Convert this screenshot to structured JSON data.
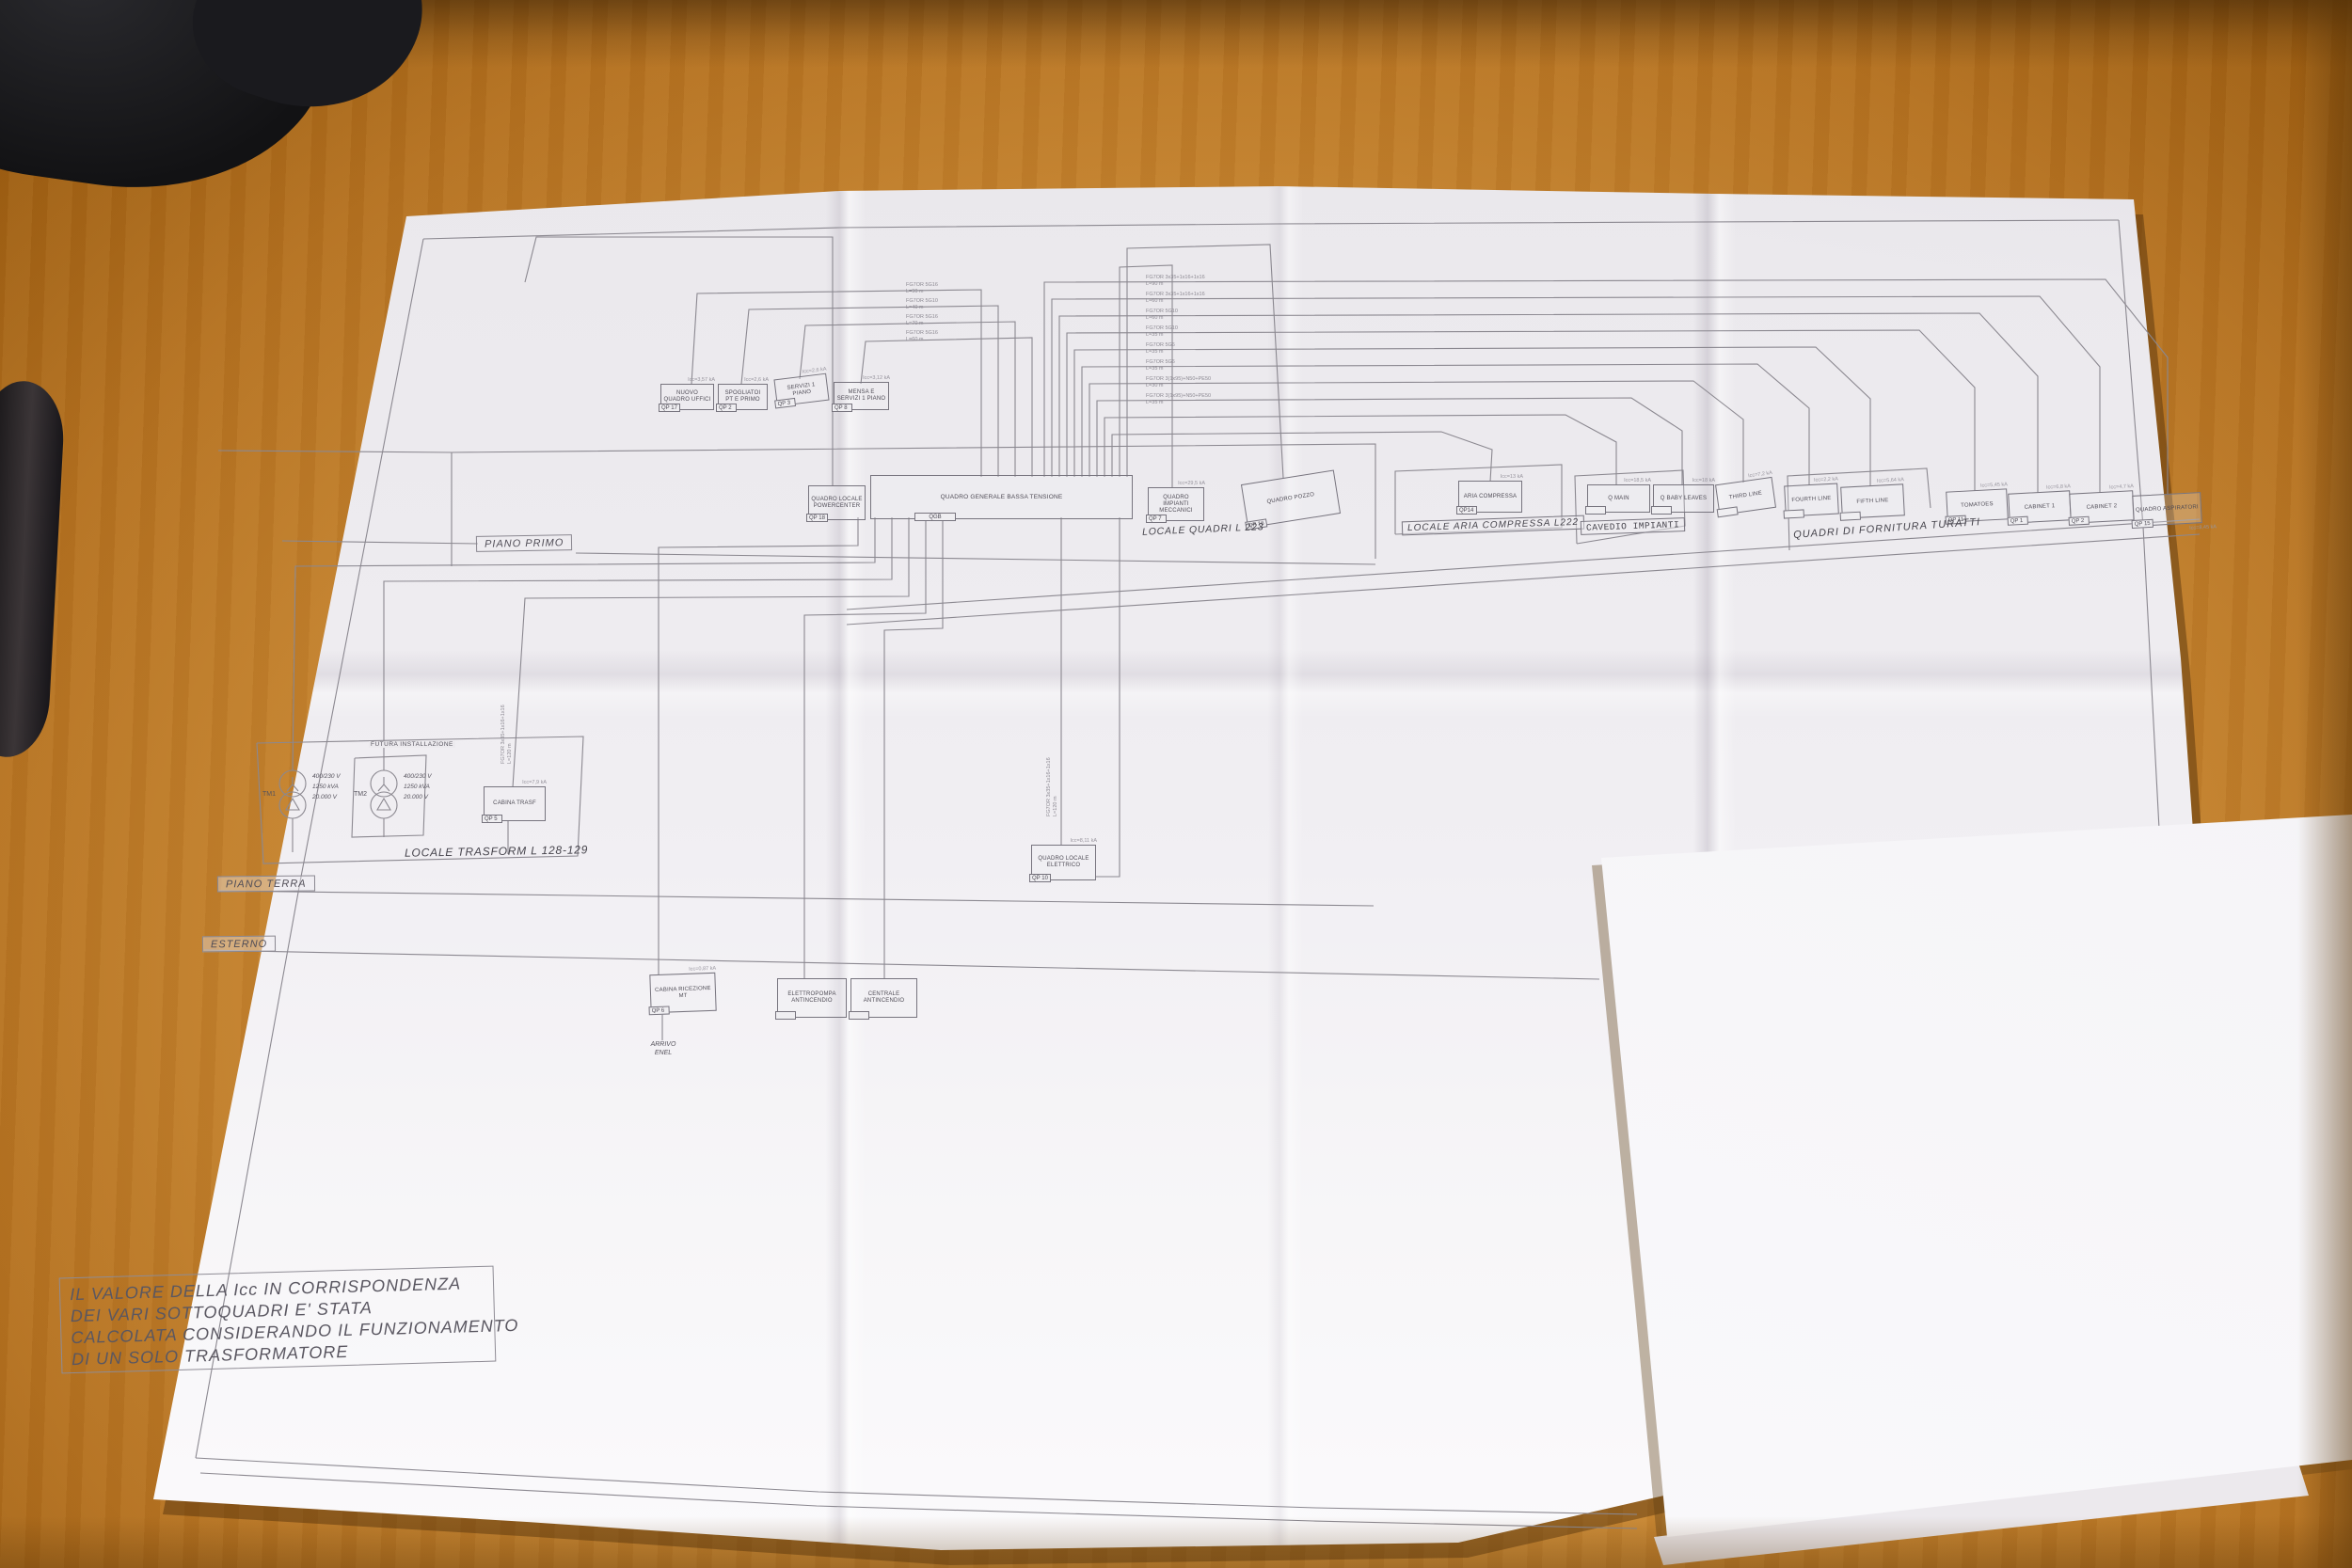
{
  "diagram": {
    "note_lines": [
      "IL VALORE DELLA Icc IN CORRISPONDENZA",
      "DEI VARI SOTTOQUADRI E' STATA",
      "CALCOLATA CONSIDERANDO IL FUNZIONAMENTO",
      "DI UN SOLO TRASFORMATORE"
    ],
    "floor_labels": {
      "primo": "PIANO PRIMO",
      "terra": "PIANO TERRA",
      "esterno": "ESTERNO"
    },
    "section_labels": {
      "trasform": "LOCALE TRASFORM L 128-129",
      "quadri": "LOCALE QUADRI L 223",
      "aria": "LOCALE ARIA COMPRESSA L222",
      "cavedio": "CAVEDIO IMPIANTI",
      "turatti": "QUADRI DI FORNITURA TURATTI",
      "futura": "FUTURA INSTALLAZIONE"
    },
    "arrivo_enel": "ARRIVO ENEL",
    "transformers": [
      {
        "id": "TM1",
        "v": "400/230 V",
        "p": "1250 kVA",
        "hv": "20.000 V"
      },
      {
        "id": "TM2",
        "v": "400/230 V",
        "p": "1250 kVA",
        "hv": "20.000 V"
      }
    ],
    "panels": [
      {
        "title": "NUOVO QUADRO UFFICI",
        "tag": "QP 17",
        "icc": "Icc=3,57 kA"
      },
      {
        "title": "SPOGLIATOI PT E PRIMO",
        "tag": "QP 2",
        "icc": "Icc=2,6 kA"
      },
      {
        "title": "SERVIZI 1 PIANO",
        "tag": "QP 3",
        "icc": "Icc=2,6 kA"
      },
      {
        "title": "MENSA E SERVIZI 1 PIANO",
        "tag": "QP 8",
        "icc": "Icc=3,12 kA"
      },
      {
        "title": "QUADRO LOCALE POWERCENTER",
        "tag": "QP 18",
        "icc": ""
      },
      {
        "title": "QUADRO GENERALE BASSA TENSIONE",
        "tag": "QGB",
        "icc": ""
      },
      {
        "title": "QUADRO IMPIANTI MECCANICI",
        "tag": "QP 7",
        "icc": "Icc=29,5 kA"
      },
      {
        "title": "QUADRO POZZO",
        "tag": "QP 16",
        "icc": ""
      },
      {
        "title": "ARIA COMPRESSA",
        "tag": "QP14",
        "icc": "Icc=13 kA"
      },
      {
        "title": "Q MAIN",
        "tag": "",
        "icc": "Icc=18,5 kA"
      },
      {
        "title": "Q BABY LEAVES",
        "tag": "",
        "icc": "Icc=18 kA"
      },
      {
        "title": "THIRD LINE",
        "tag": "",
        "icc": "Icc=7,2 kA"
      },
      {
        "title": "FOURTH LINE",
        "tag": "",
        "icc": "Icc=2,2 kA"
      },
      {
        "title": "FIFTH LINE",
        "tag": "",
        "icc": "Icc=5,64 kA"
      },
      {
        "title": "TOMATOES",
        "tag": "QP 11",
        "icc": "Icc=5,45 kA"
      },
      {
        "title": "CABINET 1",
        "tag": "QP 1",
        "icc": "Icc=6,8 kA"
      },
      {
        "title": "CABINET 2",
        "tag": "QP 2",
        "icc": "Icc=4,7 kA"
      },
      {
        "title": "QUADRO ASPIRATORI",
        "tag": "QP 15",
        "icc": "Icc=8,45 kA"
      },
      {
        "title": "CABINA TRASF",
        "tag": "QP 5",
        "icc": "Icc=7,9 kA"
      },
      {
        "title": "QUADRO LOCALE ELETTRICO",
        "tag": "QP 10",
        "icc": "Icc=8,11 kA"
      },
      {
        "title": "CABINA RICEZIONE MT",
        "tag": "QP 6",
        "icc": "Icc=0,87 kA"
      },
      {
        "title": "ELETTROPOMPA ANTINCENDIO",
        "tag": "",
        "icc": ""
      },
      {
        "title": "CENTRALE ANTINCENDIO",
        "tag": "",
        "icc": ""
      }
    ],
    "cables": {
      "left": [
        {
          "t": "FG7OR 5G16",
          "l": "L=90 m"
        },
        {
          "t": "FG7OR 5G10",
          "l": "L=40 m"
        },
        {
          "t": "FG7OR 5G16",
          "l": "L=70 m"
        },
        {
          "t": "FG7OR 5G16",
          "l": "L=60 m"
        }
      ],
      "right": [
        {
          "t": "FG7OR 3x35+1x16+1x16",
          "l": "L=90 m"
        },
        {
          "t": "FG7OR 3x35+1x16+1x16",
          "l": "L=60 m"
        },
        {
          "t": "FG7OR 5G10",
          "l": "L=60 m"
        },
        {
          "t": "FG7OR 5G10",
          "l": "L=35 m"
        },
        {
          "t": "FG7OR 5G6",
          "l": "L=35 m"
        },
        {
          "t": "FG7OR 5G6",
          "l": "L=35 m"
        },
        {
          "t": "FG7OR 3(1x95)+N50+PE50",
          "l": "L=30 m"
        },
        {
          "t": "FG7OR 3(1x95)+N50+PE50",
          "l": "L=35 m"
        }
      ],
      "vertical": {
        "t": "FG7OR 3x35+1x16+1x16",
        "l": "L=120 m"
      }
    }
  }
}
